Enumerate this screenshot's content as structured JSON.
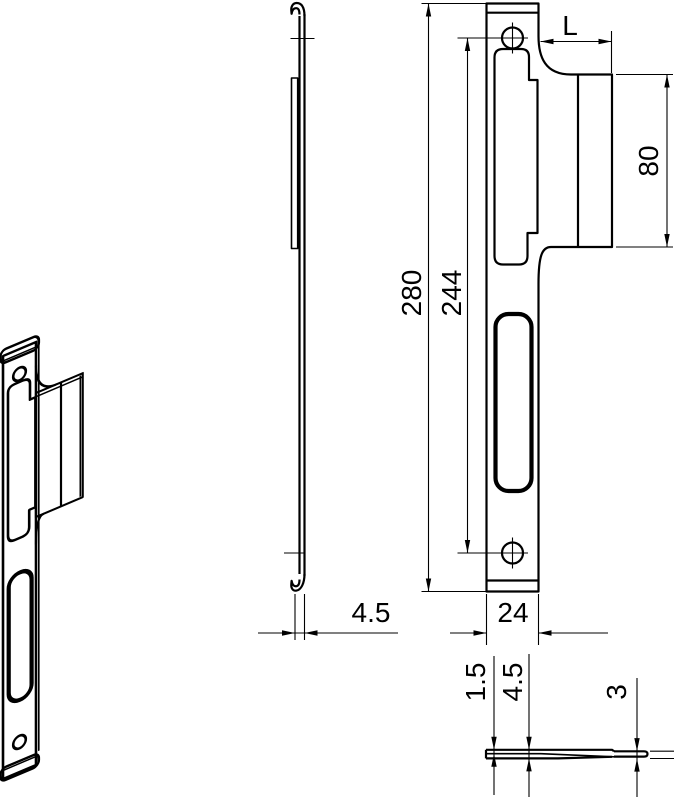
{
  "drawing": {
    "type": "technical-drawing",
    "line_color": "#000000",
    "bg_color": "#ffffff",
    "views": {
      "front": {
        "dims": {
          "overall_height": "280",
          "hole_spacing": "244",
          "tab_length": "L",
          "tab_height": "80",
          "plate_width": "24"
        }
      },
      "side": {
        "dims": {
          "profile_depth": "4.5"
        }
      },
      "section": {
        "dims": {
          "sheet_thickness": "1.5",
          "total_depth": "4.5",
          "tab_offset": "3"
        }
      }
    }
  }
}
